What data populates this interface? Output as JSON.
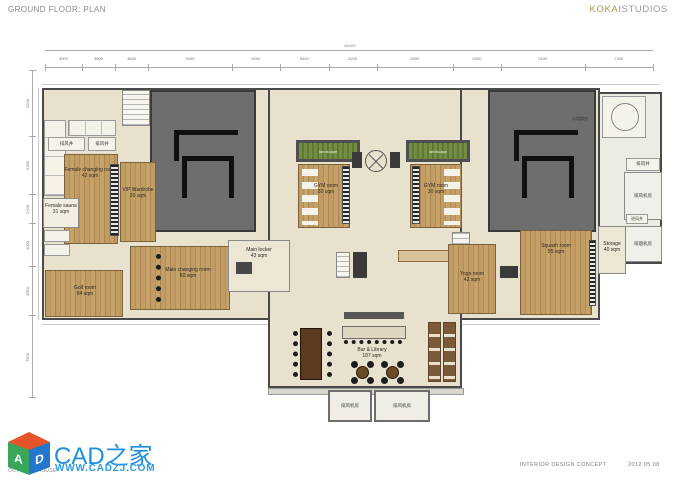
{
  "header": {
    "title": "GROUND FLOOR: PLAN",
    "brand": {
      "kokai": "KOKAI",
      "studios": "STUDIOS"
    }
  },
  "footer": {
    "project": "OCT CLUB HOUSE",
    "concept": "INTERIOR DESIGN CONCEPT",
    "date": "2012 05 08"
  },
  "watermark": {
    "title": "CAD之家",
    "url": "WWW.CADZJ.COM",
    "letter_a": "A",
    "letter_d": "D"
  },
  "plan": {
    "dim_top_total": "64100",
    "dims_top": [
      "4000",
      "3600",
      "3600",
      "9100",
      "5200",
      "5300",
      "5200",
      "8300",
      "5200",
      "9100",
      "7400"
    ],
    "dims_left": [
      "6200",
      "5300",
      "2700",
      "4000",
      "4550",
      "7500"
    ],
    "labels": {
      "shaft_tl_1": "排风井",
      "shaft_tl_2": "排风井",
      "landscape_left": "landscape",
      "landscape_right": "landscape",
      "tower_note": "公用部分",
      "shaft_r_top": "排风井",
      "fan_room_top": "排风机房",
      "shaft_r_mid": "进风井",
      "fan_room_bottom": "排烟机房",
      "fan_b_left": "排风机房",
      "fan_b_right": "排风机房"
    },
    "rooms": {
      "female_changing": {
        "name": "Female changing room",
        "area": "42 sqm"
      },
      "vip_wardrobe": {
        "name": "VIP Wardrobe",
        "area": "20 sqm"
      },
      "female_sauna": {
        "name": "Female sauna",
        "area": "31 sqm"
      },
      "gym_left": {
        "name": "GYM room",
        "area": "30 sqm"
      },
      "gym_right": {
        "name": "GYM room",
        "area": "30 sqm"
      },
      "male_changing": {
        "name": "Male changing room",
        "area": "60 sqm"
      },
      "main_locker": {
        "name": "Main locker",
        "area": "43 sqm"
      },
      "golf": {
        "name": "Golf room",
        "area": "84 sqm"
      },
      "squash": {
        "name": "Squash room",
        "area": "55 sqm"
      },
      "yoga": {
        "name": "Yoga room",
        "area": "42 sqm"
      },
      "storage": {
        "name": "Storage",
        "area": "40 sqm"
      },
      "bar_library": {
        "name": "Bar & Library",
        "area": "187 sqm"
      }
    }
  },
  "colors": {
    "brand_gold": "#b49355",
    "watermark_blue": "#1e8fe0",
    "wood": "#bf9a62",
    "tower_gray": "#6e6e6e",
    "landscape_green": "#728e44",
    "floor_cream": "#e8e1ce"
  }
}
